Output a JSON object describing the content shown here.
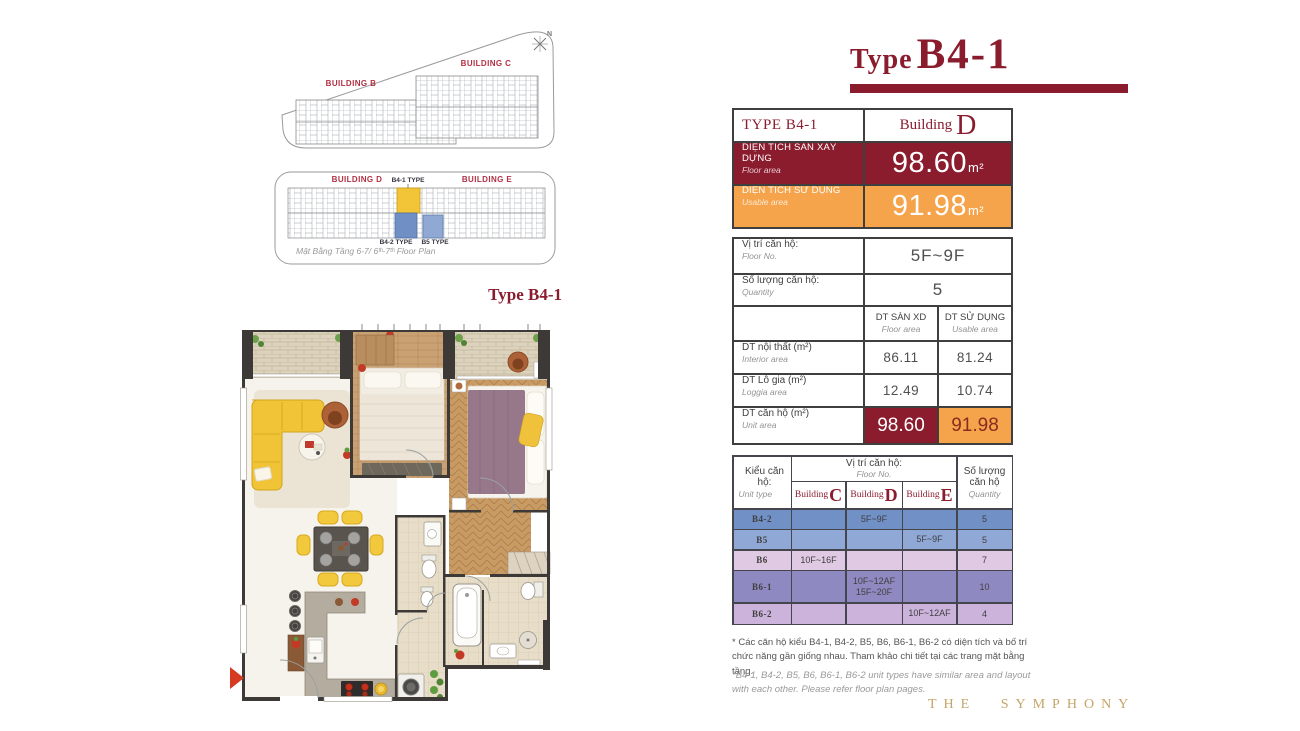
{
  "title": {
    "prefix": "Type",
    "name": "B4-1"
  },
  "site_plan_bc": {
    "building_b": "BUILDING B",
    "building_c": "BUILDING C",
    "compass_n": "N"
  },
  "site_plan_de": {
    "building_d": "BUILDING D",
    "building_e": "BUILDING E",
    "b41": "B4-1 TYPE",
    "b42": "B4-2 TYPE",
    "b5": "B5 TYPE",
    "caption": "Mặt Bằng Tầng 6-7/ 6ᵗʰ-7ᵗʰ Floor Plan"
  },
  "floorplan_label": "Type B4-1",
  "summary": {
    "type_header": "TYPE B4-1",
    "building_prefix": "Building",
    "building_letter": "D",
    "floor_area_vi": "DIỆN TÍCH SÀN XÂY DỰNG",
    "floor_area_en": "Floor area",
    "floor_area_value": "98.60",
    "usable_vi": "DIỆN TÍCH SỬ DỤNG",
    "usable_en": "Usable area",
    "usable_value": "91.98",
    "unit": "m²"
  },
  "details": {
    "position_vi": "Vị trí căn hộ:",
    "position_en": "Floor No.",
    "position_value": "5F~9F",
    "quantity_vi": "Số lượng căn hộ:",
    "quantity_en": "Quantity",
    "quantity_value": "5",
    "col_floor_vi": "DT SÀN XD",
    "col_floor_en": "Floor area",
    "col_usable_vi": "DT SỬ DỤNG",
    "col_usable_en": "Usable area",
    "rows": [
      {
        "vi": "DT nội thất (m²)",
        "en": "Interior area",
        "floor": "86.11",
        "usable": "81.24"
      },
      {
        "vi": "DT Lô gia (m²)",
        "en": "Loggia area",
        "floor": "12.49",
        "usable": "10.74"
      },
      {
        "vi": "DT căn hộ (m²)",
        "en": "Unit area",
        "floor": "98.60",
        "usable": "91.98"
      }
    ]
  },
  "units": {
    "col_type_vi": "Kiểu căn hộ:",
    "col_type_en": "Unit type",
    "col_pos_vi": "Vị trí căn hộ:",
    "col_pos_en": "Floor No.",
    "col_qty_vi1": "Số lượng",
    "col_qty_vi2": "căn hộ",
    "col_qty_en": "Quantity",
    "building_prefix": "Building",
    "building_letters": [
      "C",
      "D",
      "E"
    ],
    "rows": [
      {
        "type": "B4-2",
        "c": "",
        "d": "5F~9F",
        "e": "",
        "qty": "5"
      },
      {
        "type": "B5",
        "c": "",
        "d": "",
        "e": "5F~9F",
        "qty": "5"
      },
      {
        "type": "B6",
        "c": "10F~16F",
        "d": "",
        "e": "",
        "qty": "7"
      },
      {
        "type": "B6-1",
        "c": "",
        "d": "10F~12AF\n15F~20F",
        "e": "",
        "qty": "10"
      },
      {
        "type": "B6-2",
        "c": "",
        "d": "",
        "e": "10F~12AF",
        "qty": "4"
      }
    ]
  },
  "footnotes": {
    "vi": "* Các căn hộ kiểu B4-1, B4-2, B5, B6, B6-1, B6-2 có diện tích và bố trí chức năng gần giống nhau. Tham khảo chi tiết tại các trang mặt bằng tầng.",
    "en": "*B4-1, B4-2, B5, B6, B6-1, B6-2 unit types have similar area and layout with each other. Please refer floor plan pages."
  },
  "logo": "THE SYMPHONY",
  "colors": {
    "maroon": "#8A1C2E",
    "orange": "#F6A44C",
    "row_b42": "#7090C6",
    "row_b5": "#8FA8D5",
    "row_b6": "#E0CAE3",
    "row_b61": "#8F89C1",
    "row_b62": "#CBB3DC",
    "gold": "#C5A467",
    "highlight_yellow": "#F2C437",
    "highlight_blue": "#6F8FC5"
  }
}
